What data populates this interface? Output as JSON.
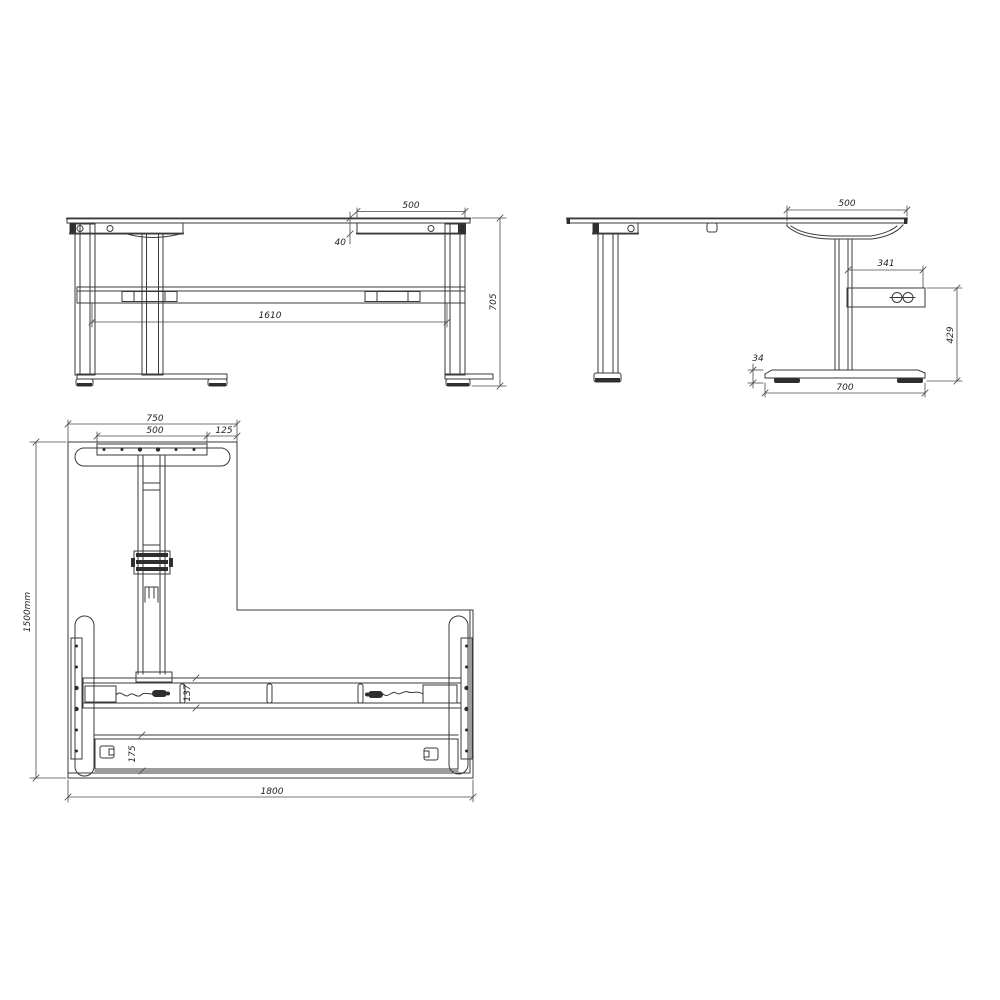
{
  "front_view": {
    "dims": {
      "bracket_width": "500",
      "top_thickness": "40",
      "leg_span": "1610",
      "frame_height": "705"
    }
  },
  "side_view": {
    "dims": {
      "bracket_width": "500",
      "control_box_width": "341",
      "control_box_floor_height": "429",
      "foot_thickness": "34",
      "foot_depth": "700"
    }
  },
  "plan_view": {
    "dims": {
      "return_top_width": "750",
      "plate_width": "500",
      "corner_offset": "125",
      "overall_depth": "1500mm",
      "beam_depth": "137",
      "rear_rail_depth": "175",
      "overall_width": "1800"
    }
  },
  "colors": {
    "line": "#3a3a3a",
    "dim_line": "#4a4a4a",
    "dark_fill": "#2e2e2e",
    "background": "#ffffff"
  }
}
